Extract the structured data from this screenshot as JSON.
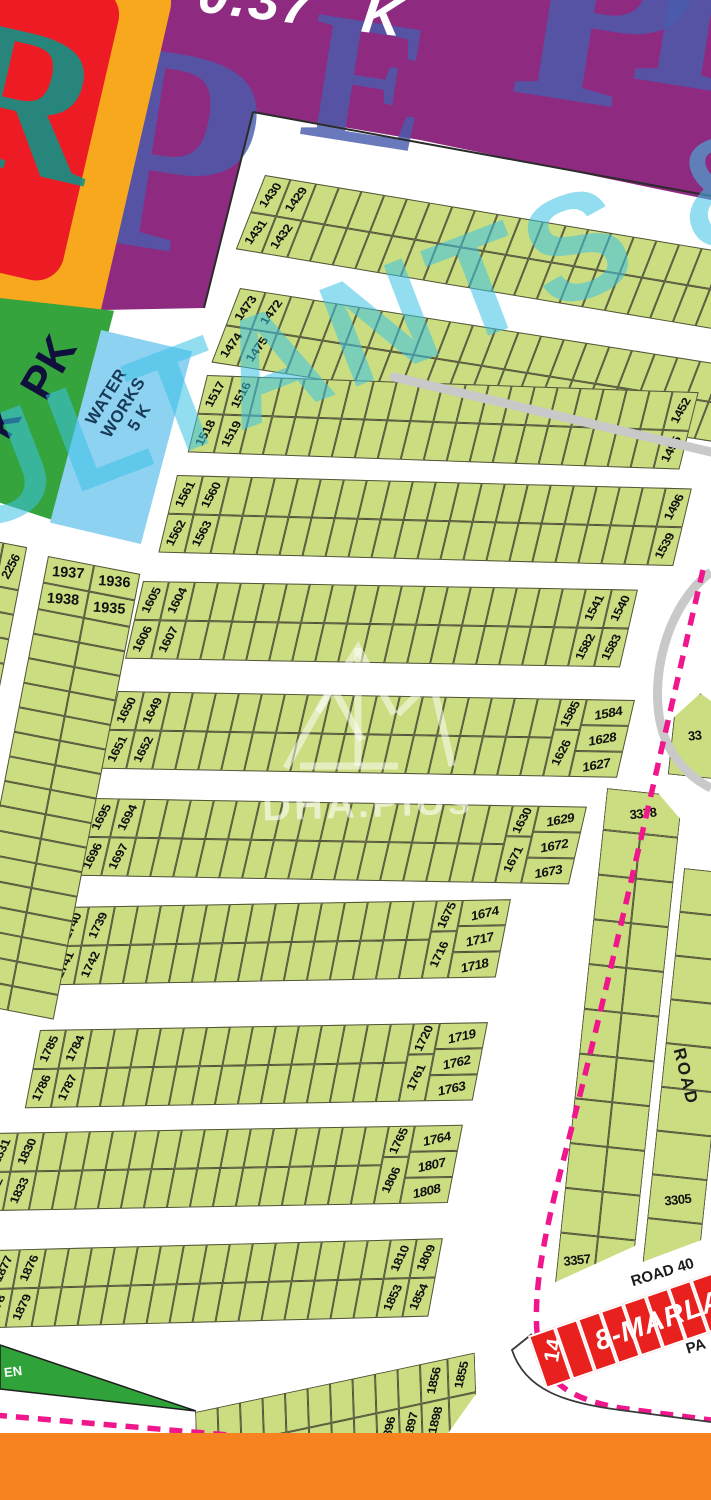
{
  "banner": {
    "value": "0.37",
    "unit": "K"
  },
  "watermark": {
    "big_letters": [
      "I",
      "P",
      "E",
      "P",
      "R"
    ],
    "cyan_text": "ULTANTS &",
    "brand": "DHA.PlUs"
  },
  "park": {
    "line1": "PK",
    "line2": "K"
  },
  "water_works": {
    "line1": "WATER",
    "line2": "WORKS",
    "line3": "5 K"
  },
  "green_belt": {
    "label": "EN"
  },
  "roads": {
    "road40": "ROAD 40",
    "road_side": "ROAD"
  },
  "labels": {
    "pa": "PA"
  },
  "red_strip": {
    "plot": "14",
    "label": "8-MARLA"
  },
  "right_plots": {
    "v1_top": "3378",
    "v1_bottom_left": "3357",
    "v1_bottom_right": "3356",
    "v2": "3305",
    "wedge": "33"
  },
  "left_column": {
    "labels": [
      "1937",
      "1936",
      "1938",
      "1935"
    ]
  },
  "left_stub": {
    "labels": [
      "2212",
      "2256"
    ]
  },
  "strips": {
    "A": {
      "left": [
        "1430",
        "1429",
        "1431",
        "1432"
      ]
    },
    "B": {
      "left": [
        "1473",
        "1472",
        "1474",
        "1475"
      ]
    },
    "C": {
      "left": [
        "1517",
        "1516",
        "1518",
        "1519"
      ],
      "right_col": [
        "1452",
        "1495"
      ]
    },
    "D": {
      "left": [
        "1561",
        "1560",
        "1562",
        "1563"
      ],
      "right_col": [
        "1496",
        "1539"
      ]
    },
    "E": {
      "left": [
        "1605",
        "1604",
        "1606",
        "1607"
      ],
      "right": [
        "1541",
        "1540",
        "1582",
        "1583"
      ]
    },
    "F": {
      "left": [
        "1650",
        "1649",
        "1651",
        "1652"
      ],
      "right_side": [
        "1585",
        "1626"
      ],
      "right_main": [
        "1584",
        "1628",
        "1627"
      ]
    },
    "G": {
      "left": [
        "1695",
        "1694",
        "1696",
        "1697"
      ],
      "right_side": [
        "1630",
        "1671"
      ],
      "right_main": [
        "1629",
        "1672",
        "1673"
      ]
    },
    "H": {
      "left": [
        "1740",
        "1739",
        "1741",
        "1742"
      ],
      "right_side": [
        "1675",
        "1716"
      ],
      "right_main": [
        "1674",
        "1717",
        "1718"
      ]
    },
    "I": {
      "left": [
        "1785",
        "1784",
        "1786",
        "1787"
      ],
      "right_side": [
        "1720",
        "1761"
      ],
      "right_main": [
        "1719",
        "1762",
        "1763"
      ]
    },
    "J": {
      "left": [
        "1831",
        "1830",
        "1832",
        "1833"
      ],
      "right_side": [
        "1765",
        "1806"
      ],
      "right_main": [
        "1764",
        "1807",
        "1808"
      ]
    },
    "K": {
      "left": [
        "1877",
        "1876",
        "1878",
        "1879"
      ],
      "right": [
        "1810",
        "1809",
        "1853",
        "1854"
      ]
    },
    "L": {
      "right_top": [
        "1856",
        "1855"
      ],
      "bottom": [
        "1896",
        "1897"
      ],
      "corner": "1898"
    }
  },
  "colors": {
    "banner_purple": "#8e2a80",
    "plot_green": "#cadd80",
    "park_green": "#35a43d",
    "water_blue": "#8ed2f2",
    "red_marla": "#e8211e",
    "orange_bar": "#f6831f",
    "boundary_pink": "#f0168c",
    "watermark_blue": "#4a5cae",
    "watermark_cyan": "#3cc3e6",
    "road_gray": "#c9c9c9"
  }
}
